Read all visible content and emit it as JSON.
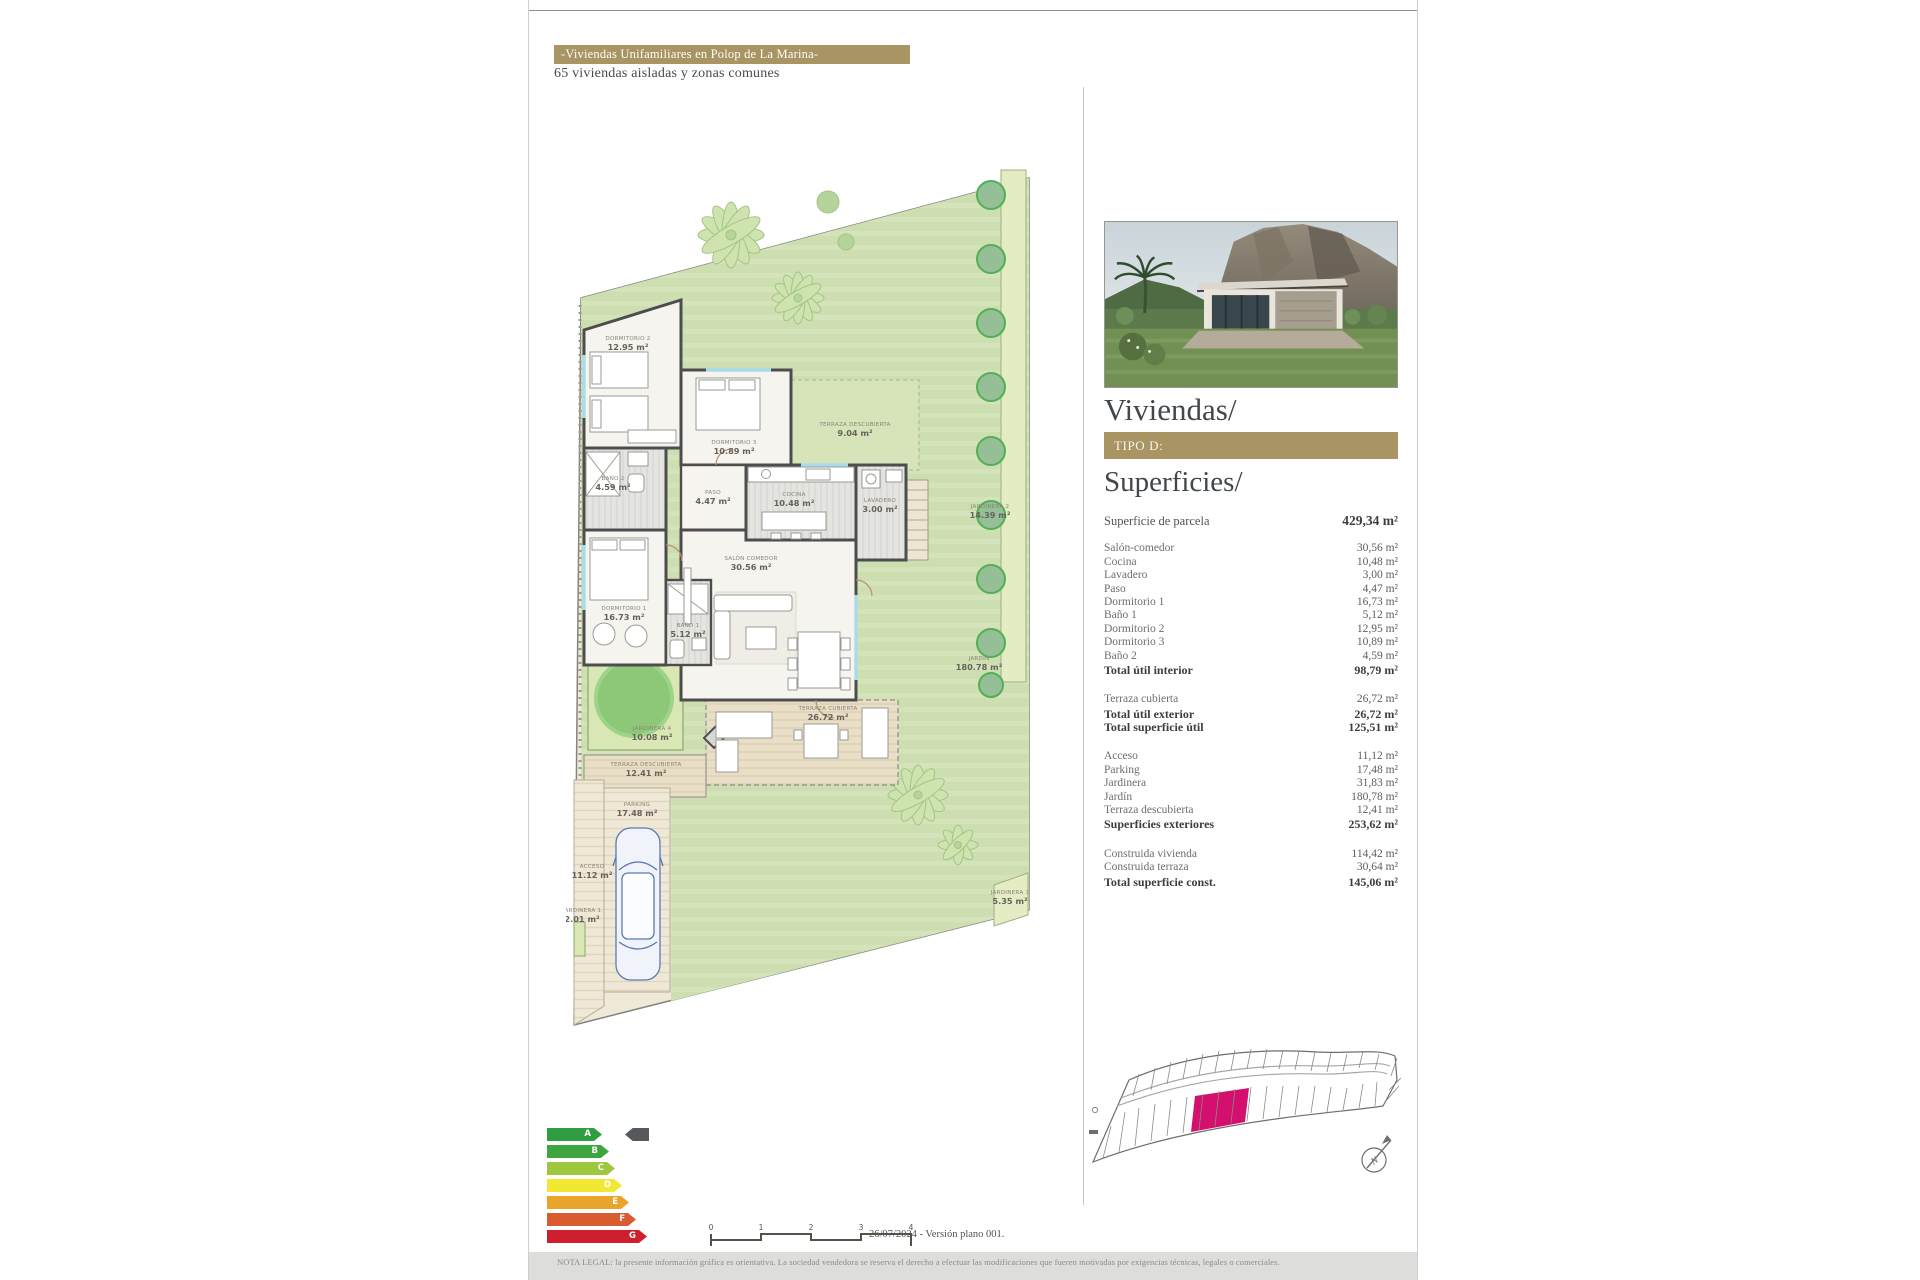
{
  "header": {
    "title": "-Viviendas Unifamiliares en Polop de La Marina-",
    "subtitle": "65 viviendas aisladas y zonas comunes"
  },
  "panel": {
    "viviendas_title": "Viviendas/",
    "type_label": "TIPO D:",
    "superficies_title": "Superficies/"
  },
  "surfaces": {
    "rows": [
      {
        "label": "Superficie de parcela",
        "value": "429,34 m²"
      },
      {
        "label": "Salón-comedor",
        "value": "30,56 m²"
      },
      {
        "label": "Cocina",
        "value": "10,48 m²"
      },
      {
        "label": "Lavadero",
        "value": "3,00 m²"
      },
      {
        "label": "Paso",
        "value": "4,47 m²"
      },
      {
        "label": "Dormitorio 1",
        "value": "16,73 m²"
      },
      {
        "label": "Baño 1",
        "value": "5,12 m²"
      },
      {
        "label": "Dormitorio 2",
        "value": "12,95 m²"
      },
      {
        "label": "Dormitorio 3",
        "value": "10,89 m²"
      },
      {
        "label": "Baño 2",
        "value": "4,59 m²"
      },
      {
        "label": "Total útil interior",
        "value": "98,79 m²"
      },
      {
        "label": "Terraza cubierta",
        "value": "26,72 m²"
      },
      {
        "label": "Total útil exterior",
        "value": "26,72 m²"
      },
      {
        "label": "Total superficie útil",
        "value": "125,51 m²"
      },
      {
        "label": "Acceso",
        "value": "11,12 m²"
      },
      {
        "label": "Parking",
        "value": "17,48 m²"
      },
      {
        "label": "Jardinera",
        "value": "31,83 m²"
      },
      {
        "label": "Jardín",
        "value": "180,78 m²"
      },
      {
        "label": "Terraza descubierta",
        "value": "12,41 m²"
      },
      {
        "label": "Superficies exteriores",
        "value": "253,62 m²"
      },
      {
        "label": "Construida vivienda",
        "value": "114,42 m²"
      },
      {
        "label": "Construida terraza",
        "value": "30,64 m²"
      },
      {
        "label": "Total superficie const.",
        "value": "145,06 m²"
      }
    ]
  },
  "plan": {
    "rooms": [
      {
        "name": "DORMITORIO 2",
        "area": "12.95 m²"
      },
      {
        "name": "BAÑO 2",
        "area": "4.59 m²"
      },
      {
        "name": "DORMITORIO 3",
        "area": "10.89 m²"
      },
      {
        "name": "PASO",
        "area": "4.47 m²"
      },
      {
        "name": "COCINA",
        "area": "10.48 m²"
      },
      {
        "name": "LAVADERO",
        "area": "3.00 m²"
      },
      {
        "name": "SALÓN COMEDOR",
        "area": "30.56 m²"
      },
      {
        "name": "DORMITORIO 1",
        "area": "16.73 m²"
      },
      {
        "name": "BAÑO 1",
        "area": "5.12 m²"
      },
      {
        "name": "TERRAZA DESCUBIERTA",
        "area": "9.04 m²"
      },
      {
        "name": "TERRAZA CUBIERTA",
        "area": "26.72 m²"
      },
      {
        "name": "JARDINERA 2",
        "area": "14.39 m²"
      },
      {
        "name": "JARDIN",
        "area": "180.78 m²"
      },
      {
        "name": "JARDINERA 4",
        "area": "10.08 m²"
      },
      {
        "name": "TERRAZA DESCUBIERTA",
        "area": "12.41 m²"
      },
      {
        "name": "ACCESO",
        "area": "11.12 m²"
      },
      {
        "name": "PARKING",
        "area": "17.48 m²"
      },
      {
        "name": "JARDINERA 1",
        "area": "2.01 m²"
      },
      {
        "name": "JARDINERA 3",
        "area": "5.35 m²"
      }
    ]
  },
  "map": {
    "north_label": "N"
  },
  "energy": {
    "grades": [
      "A",
      "B",
      "C",
      "D",
      "E",
      "F",
      "G"
    ],
    "colors": [
      "#2f9e41",
      "#3fa53f",
      "#9ec73e",
      "#f2e833",
      "#eaa42c",
      "#d95b30",
      "#cf1f2f"
    ]
  },
  "footer": {
    "scale_ticks": [
      "0",
      "1",
      "2",
      "3",
      "4"
    ],
    "version": "26/07/2024 - Versión plano 001.",
    "legal": "NOTA LEGAL: la presente información gráfica es orientativa. La sociedad vendedora se reserva el derecho a efectuar las modificaciones que fueren motivadas por exigencias técnicas, legales o comerciales."
  },
  "colors": {
    "accent_gold": "#a99463",
    "highlight_plot": "#d40f6e",
    "garden_green": "#cfe0b2"
  }
}
